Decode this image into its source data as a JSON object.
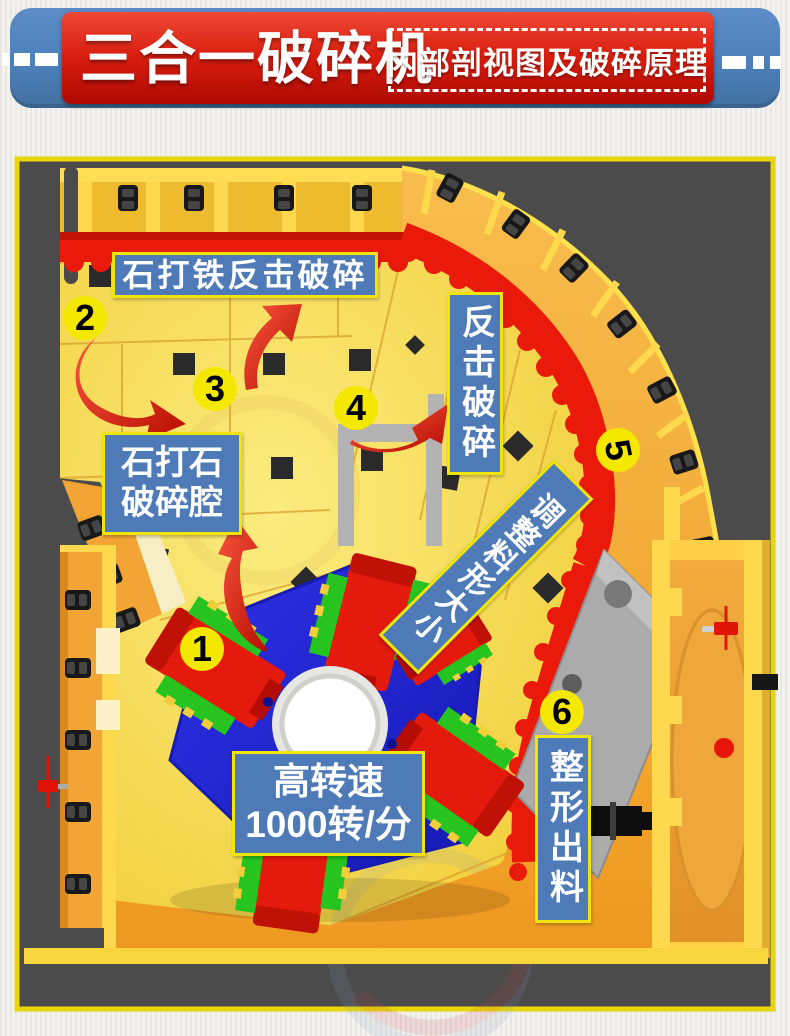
{
  "header": {
    "title": "三合一破碎机",
    "subtitle": "内部剖视图及破碎原理",
    "banner_color": "#4d80bb",
    "box_color": "#d91e0f"
  },
  "diagram": {
    "background": "#4b4b4b",
    "border_color": "#e8d60a",
    "palette": {
      "chamber_yellow": "#f6d93e",
      "shell_orange": "#f0a030",
      "liner_red": "#ea1a0a",
      "rotor_blue": "#2228d8",
      "hammer_green": "#27c41f",
      "hammer_red": "#e41a0c",
      "label_blue": "#4e7bb8",
      "step_badge_yellow": "#f4e800",
      "plate_gray": "#ababab"
    },
    "steps": [
      {
        "number": "1"
      },
      {
        "number": "2"
      },
      {
        "number": "3"
      },
      {
        "number": "4"
      },
      {
        "number": "5"
      },
      {
        "number": "6"
      }
    ],
    "labels": {
      "impact_top": "石打铁反击破碎",
      "impact_right": "反击破碎",
      "chamber_line1": "石打石",
      "chamber_line2": "破碎腔",
      "speed_line1": "高转速",
      "speed_line2": "1000转/分",
      "adjust": "调整料形大小",
      "discharge": "整形出料"
    }
  }
}
